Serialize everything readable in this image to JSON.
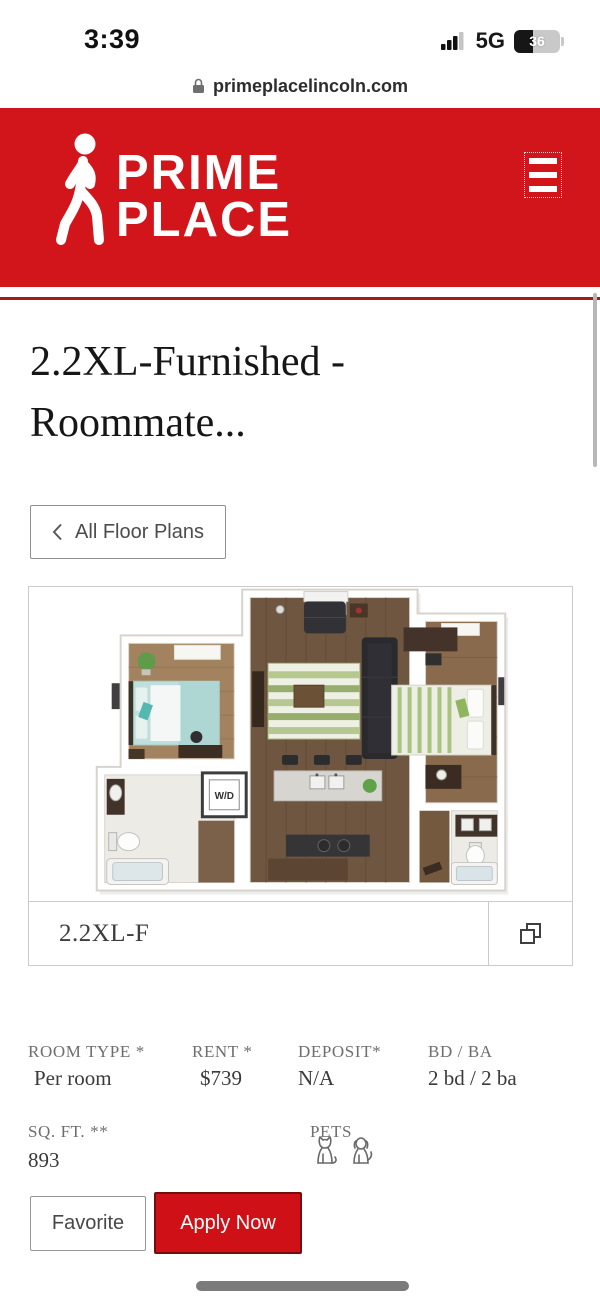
{
  "status_bar": {
    "time": "3:39",
    "network": "5G",
    "battery_level": "36"
  },
  "url_bar": {
    "domain": "primeplacelincoln.com"
  },
  "header": {
    "logo_line1": "PRIME",
    "logo_line2": "PLACE"
  },
  "page": {
    "title_line1": "2.2XL-Furnished -",
    "title_line2": "Roommate..."
  },
  "back_button": {
    "label": "All Floor Plans"
  },
  "floor_plan": {
    "caption": "2.2XL-F",
    "wd_label": "W/D"
  },
  "details": {
    "room_type_label": "ROOM TYPE *",
    "room_type_value": "Per room",
    "rent_label": "RENT *",
    "rent_value": "$739",
    "deposit_label": "DEPOSIT*",
    "deposit_value": "N/A",
    "bd_ba_label": "BD / BA",
    "bd_ba_value": "2 bd / 2 ba",
    "sq_ft_label": "SQ. FT. **",
    "sq_ft_value": "893",
    "pets_label": "PETS"
  },
  "actions": {
    "favorite_label": "Favorite",
    "apply_label": "Apply Now"
  },
  "colors": {
    "brand_red": "#d2151b",
    "divider_red": "#a11b1e",
    "apply_red": "#cf1016"
  }
}
